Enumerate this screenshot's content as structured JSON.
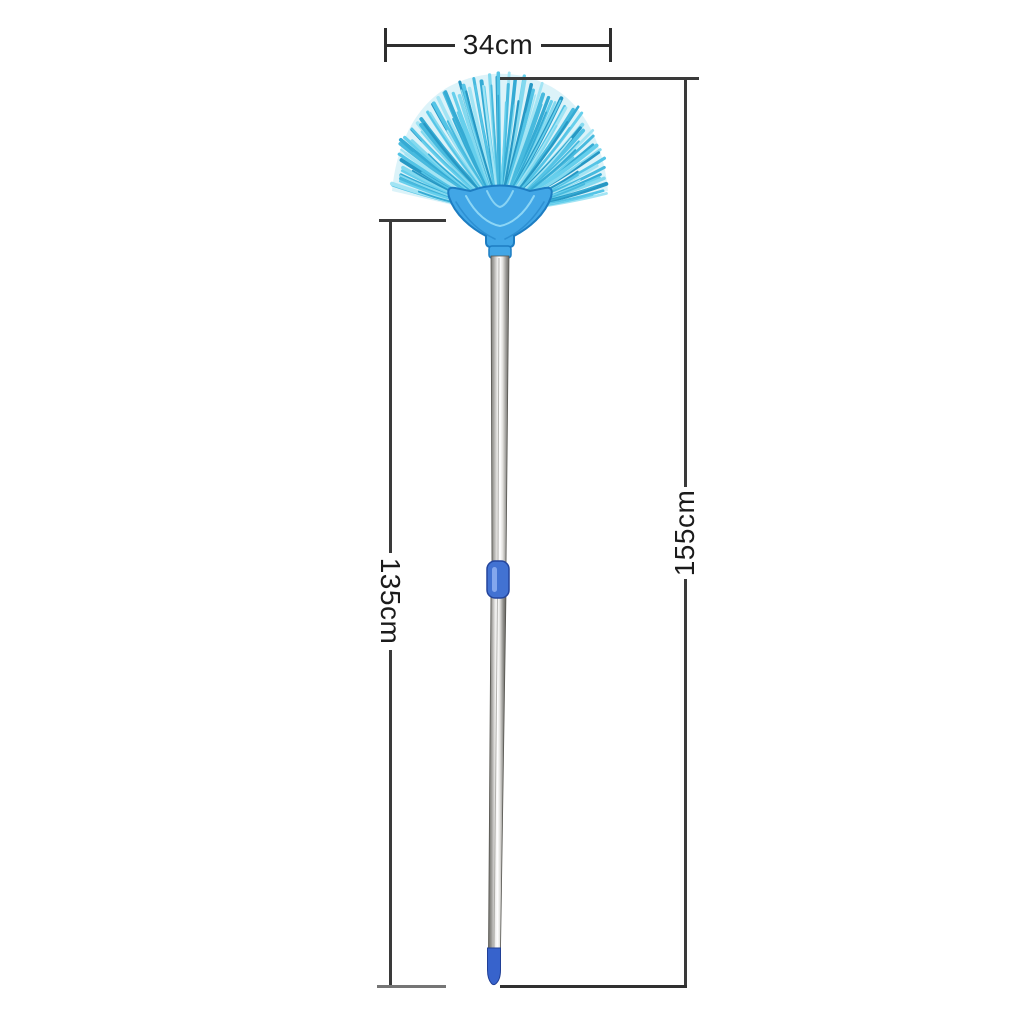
{
  "page": {
    "background": "#ffffff"
  },
  "annotations": {
    "brush_width": {
      "label": "34cm"
    },
    "handle_length": {
      "label": "135cm"
    },
    "total_length": {
      "label": "155cm"
    }
  },
  "product": {
    "description": "blue fan-shaped broom duster with telescopic metal handle",
    "colors": {
      "bristles": [
        "#54c4e6",
        "#83d9ef",
        "#35abd4",
        "#a2e4f4",
        "#2798c4",
        "#66cfec",
        "#48bade"
      ],
      "bristle_fill": "#b9e7f4",
      "holder": "#41a6e6",
      "holder_outline": "#1d7dc2",
      "holder_highlight": "#9adef8",
      "grip": "#4272d2",
      "tip": "#3763cc"
    }
  }
}
